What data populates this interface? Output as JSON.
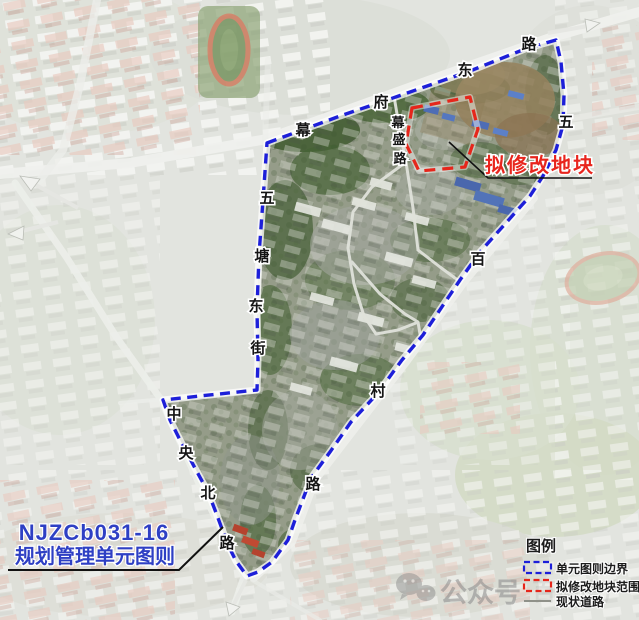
{
  "map": {
    "title_context": "satellite planning map",
    "unit_label": {
      "line1": "NJZCb031-16",
      "line2": "规划管理单元图则"
    },
    "modify_label": "拟修改地块",
    "road_labels": [
      {
        "road": "幕府东路",
        "chars": [
          "幕",
          "府",
          "东",
          "路"
        ]
      },
      {
        "road": "幕盛路",
        "chars": [
          "幕",
          "盛",
          "路"
        ]
      },
      {
        "road": "五百村路",
        "chars": [
          "五",
          "百",
          "村",
          "路"
        ]
      },
      {
        "road": "五塘东街",
        "chars": [
          "五",
          "塘",
          "东",
          "街"
        ]
      },
      {
        "road": "中央北路",
        "chars": [
          "中",
          "央",
          "北",
          "路"
        ]
      }
    ]
  },
  "legend": {
    "title": "图例",
    "items": [
      {
        "label": "单元图则边界",
        "symbol": "blue-dashed-box"
      },
      {
        "label": "拟修改地块范围",
        "symbol": "red-dashed-box"
      },
      {
        "label": "现状道路",
        "symbol": "gray-line"
      }
    ]
  },
  "watermark": {
    "text": "公众号",
    "faint_text": "百何房产",
    "icon": "wechat-icon"
  },
  "colors": {
    "boundary_blue": "#1d1fd9",
    "modify_red": "#e6261b",
    "label_blue": "#2e3fc4",
    "road_label_black": "#151515"
  }
}
